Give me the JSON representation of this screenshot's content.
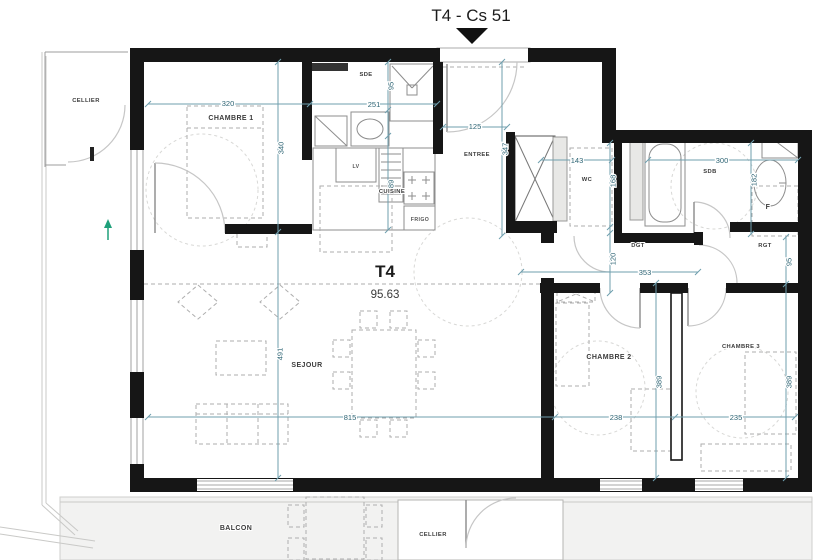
{
  "header": {
    "title": "T4 - Cs 51"
  },
  "unit": {
    "type": "T4",
    "area": "95.63"
  },
  "rooms": {
    "cellier_top": "CELLIER",
    "chambre1": "CHAMBRE 1",
    "sde": "SDE",
    "entree": "ENTREE",
    "wc": "WC",
    "sdb": "SDB",
    "dgt": "DGT",
    "rgt": "RGT",
    "cuisine": "CUISINE",
    "sejour": "SEJOUR",
    "chambre2": "CHAMBRE 2",
    "chambre3": "CHAMBRE 3",
    "balcon": "BALCON",
    "cellier_bottom": "CELLIER"
  },
  "appliances": {
    "dishwasher": "LV",
    "fridge": "FRIGO",
    "f_unit": "F"
  },
  "dims": {
    "chambre1_w": "320",
    "chambre1_h": "340",
    "sde_w": "251",
    "sde_d": "95",
    "entree_w": "125",
    "entree_h": "347",
    "wc_w": "143",
    "wc_h": "168",
    "sdb_w": "300",
    "sdb_h": "182",
    "dgt_w": "353",
    "dgt_h": "120",
    "rgt_h": "95",
    "cuisine_h": "189",
    "sejour_w": "815",
    "sejour_h": "491",
    "chambre2_w": "238",
    "chambre2_h": "389",
    "chambre3_w": "235",
    "chambre3_h": "389"
  },
  "colors": {
    "wall": "#161616",
    "dimension_line": "#6f9fae",
    "dimension_text": "#2d6474",
    "marker_green": "#1fa07a"
  }
}
